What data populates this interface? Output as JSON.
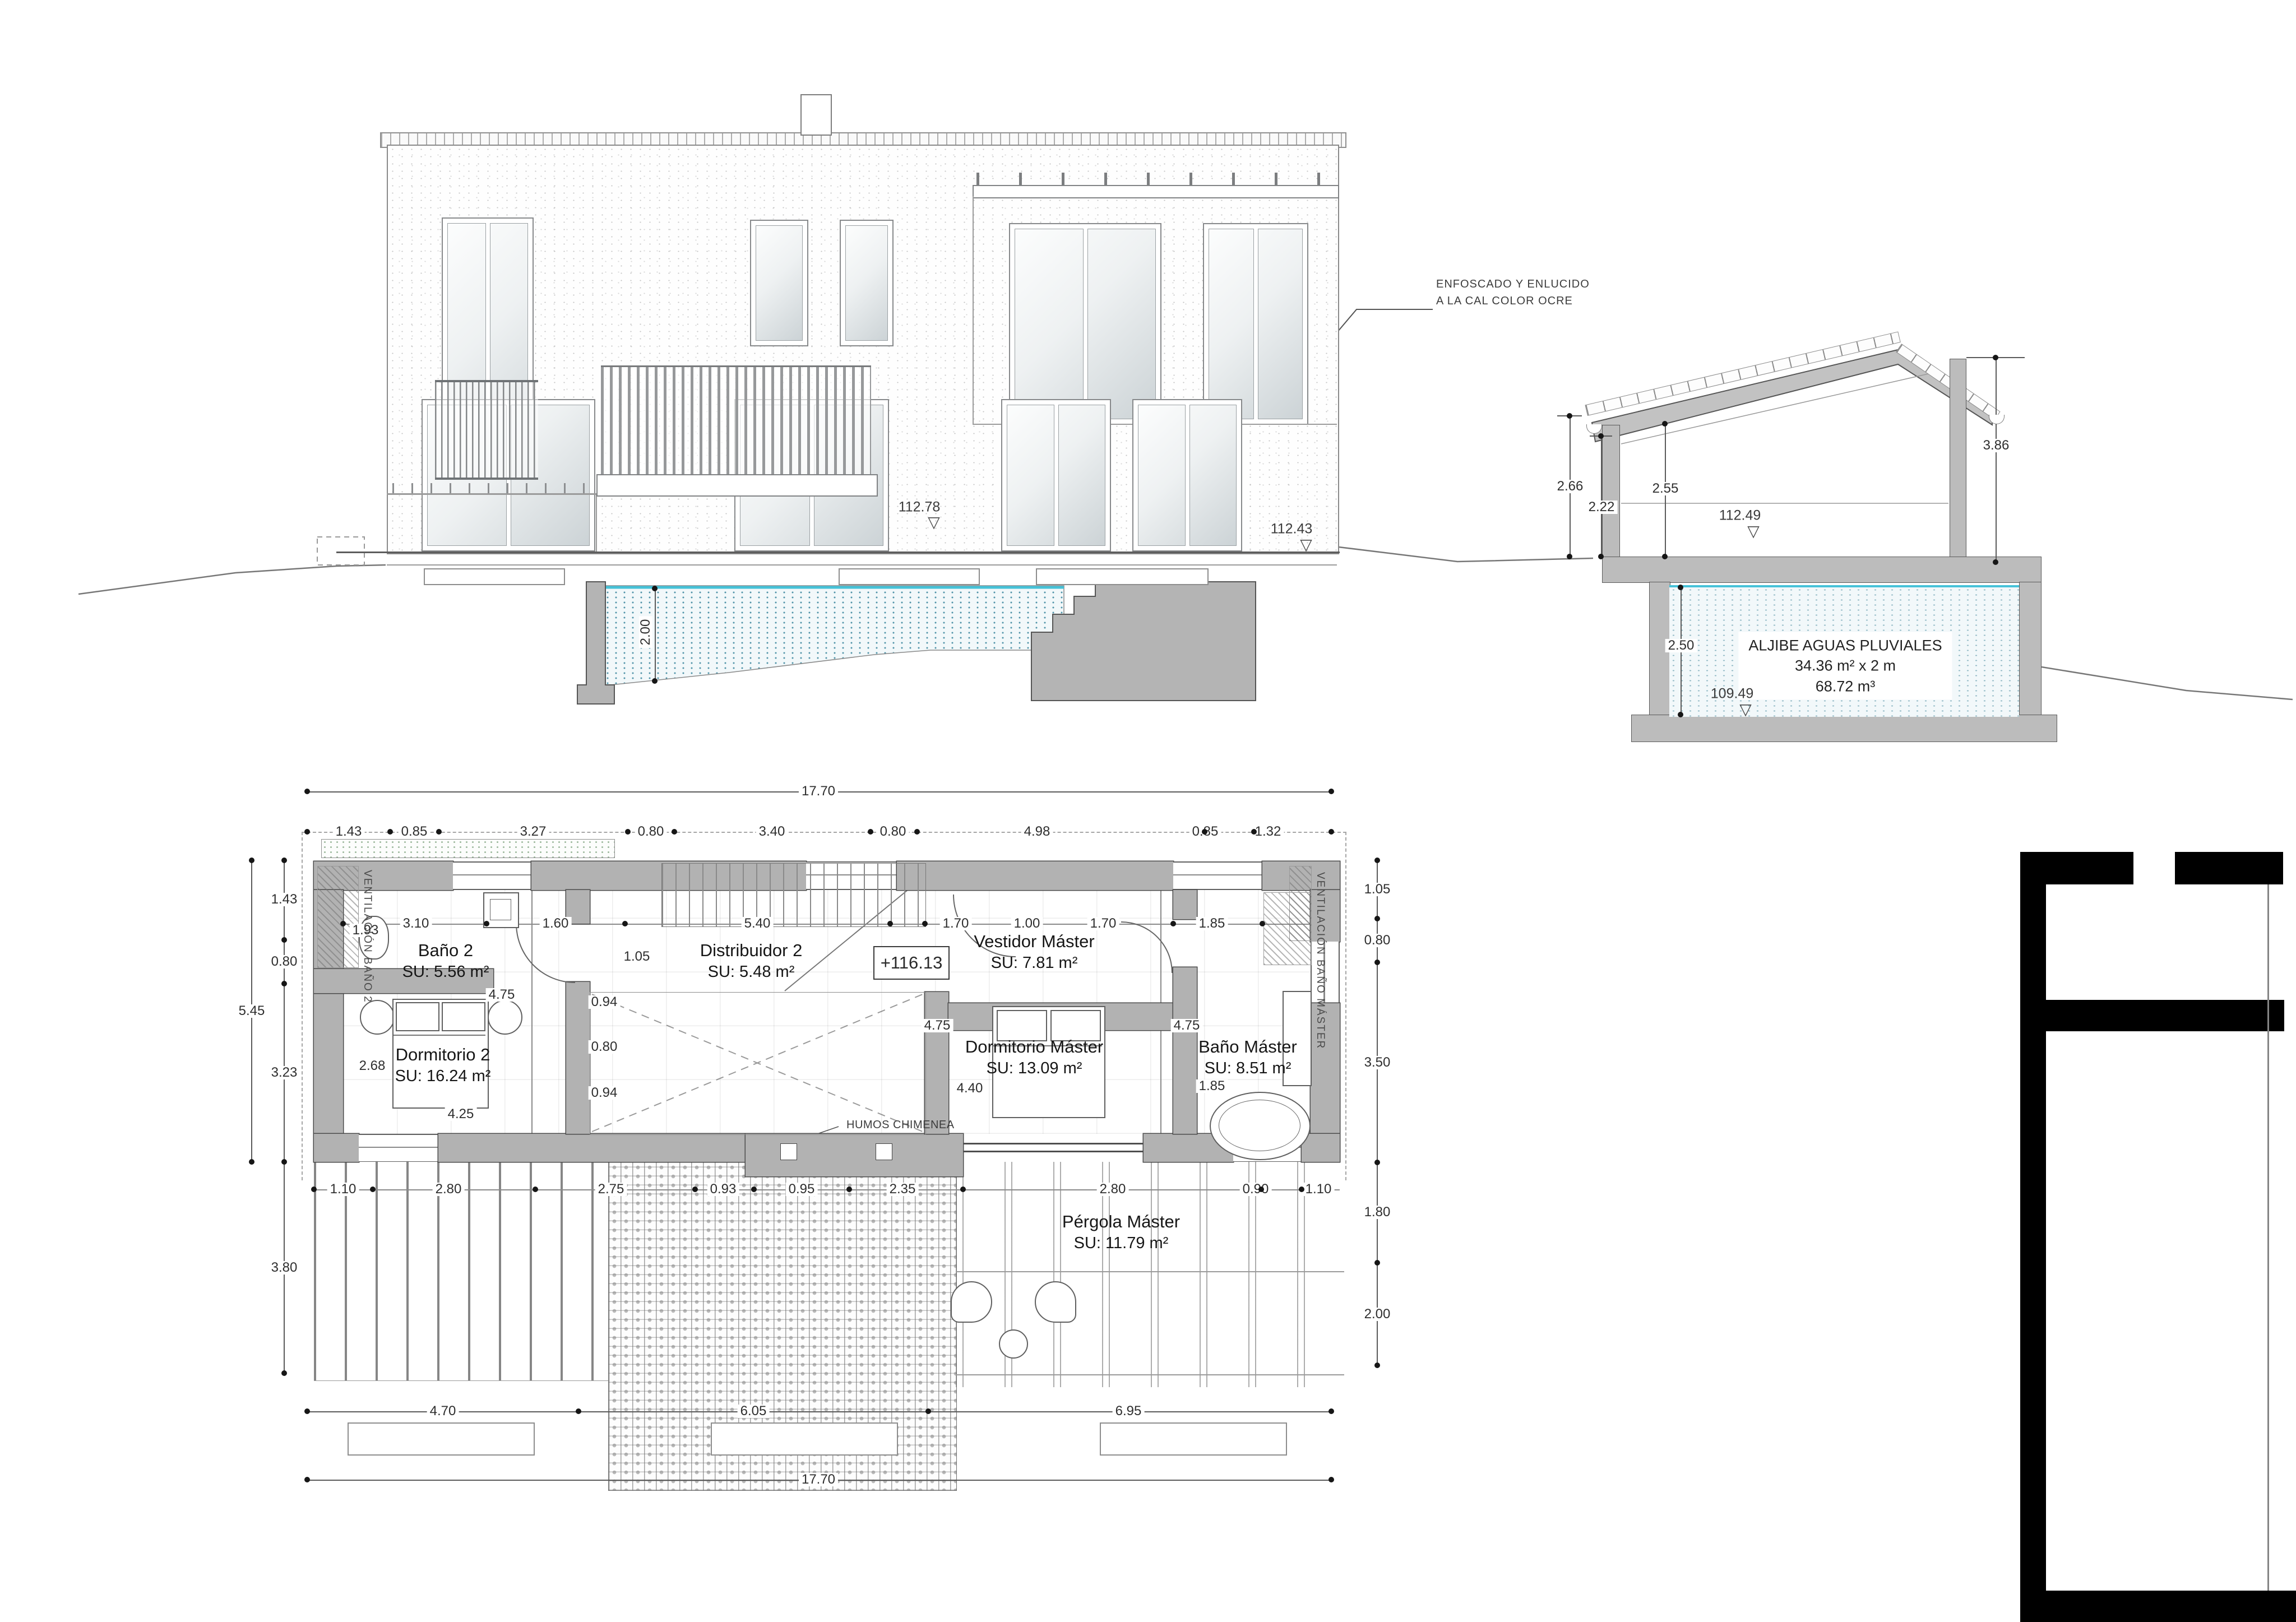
{
  "annotation": {
    "line1": "ENFOSCADO Y ENLUCIDO",
    "line2": "A LA CAL COLOR OCRE"
  },
  "elevation": {
    "levels": [
      "112.78",
      "112.43"
    ],
    "pool_depth": "2.00"
  },
  "section": {
    "dims": {
      "left_outer": "2.66",
      "left_inner": "2.22",
      "interior": "2.55",
      "right": "3.86",
      "cistern_depth": "2.50"
    },
    "levels": {
      "floor": "112.49",
      "cistern_bottom": "109.49"
    },
    "cistern": {
      "title": "ALJIBE AGUAS PLUVIALES",
      "size": "34.36 m² x 2 m",
      "volume": "68.72 m³"
    }
  },
  "plan": {
    "level": "+116.13",
    "rooms": [
      {
        "name": "Baño 2",
        "area": "SU: 5.56 m²"
      },
      {
        "name": "Dormitorio 2",
        "area": "SU: 16.24 m²"
      },
      {
        "name": "Distribuidor 2",
        "area": "SU: 5.48 m²"
      },
      {
        "name": "Vestidor Máster",
        "area": "SU: 7.81 m²"
      },
      {
        "name": "Dormitorio Máster",
        "area": "SU: 13.09 m²"
      },
      {
        "name": "Baño Máster",
        "area": "SU: 8.51 m²"
      },
      {
        "name": "Pérgola Máster",
        "area": "SU: 11.79 m²"
      }
    ],
    "notes": {
      "humos": "HUMOS CHIMENEA",
      "vent2": "VENTILACIÓN BAÑO 2",
      "ventm": "VENTILACIÓN BAÑO MÁSTER"
    },
    "dims": {
      "overall_top": "17.70",
      "overall_bottom": "17.70",
      "top": [
        "1.43",
        "0.85",
        "3.27",
        "0.80",
        "3.40",
        "0.80",
        "4.98",
        "0.85",
        "1.32"
      ],
      "left_total": "5.45",
      "left": [
        "1.43",
        "0.80",
        "3.23"
      ],
      "left_lower": "3.80",
      "right": [
        "1.05",
        "0.80",
        "3.50",
        "1.80",
        "2.00"
      ],
      "bottom": [
        "4.70",
        "6.05",
        "6.95"
      ],
      "row2": [
        "3.10",
        "1.60",
        "5.40",
        "1.70",
        "1.00",
        "1.70",
        "1.85"
      ],
      "interior": [
        "1.93",
        "1.05",
        "2.68",
        "4.75",
        "0.94",
        "0.80",
        "0.94",
        "4.25",
        "4.75",
        "4.40",
        "1.85",
        "4.75"
      ],
      "pergola": [
        "1.10",
        "2.80",
        "2.75",
        "0.93",
        "0.95",
        "2.35",
        "2.80",
        "0.90",
        "1.10"
      ]
    }
  }
}
